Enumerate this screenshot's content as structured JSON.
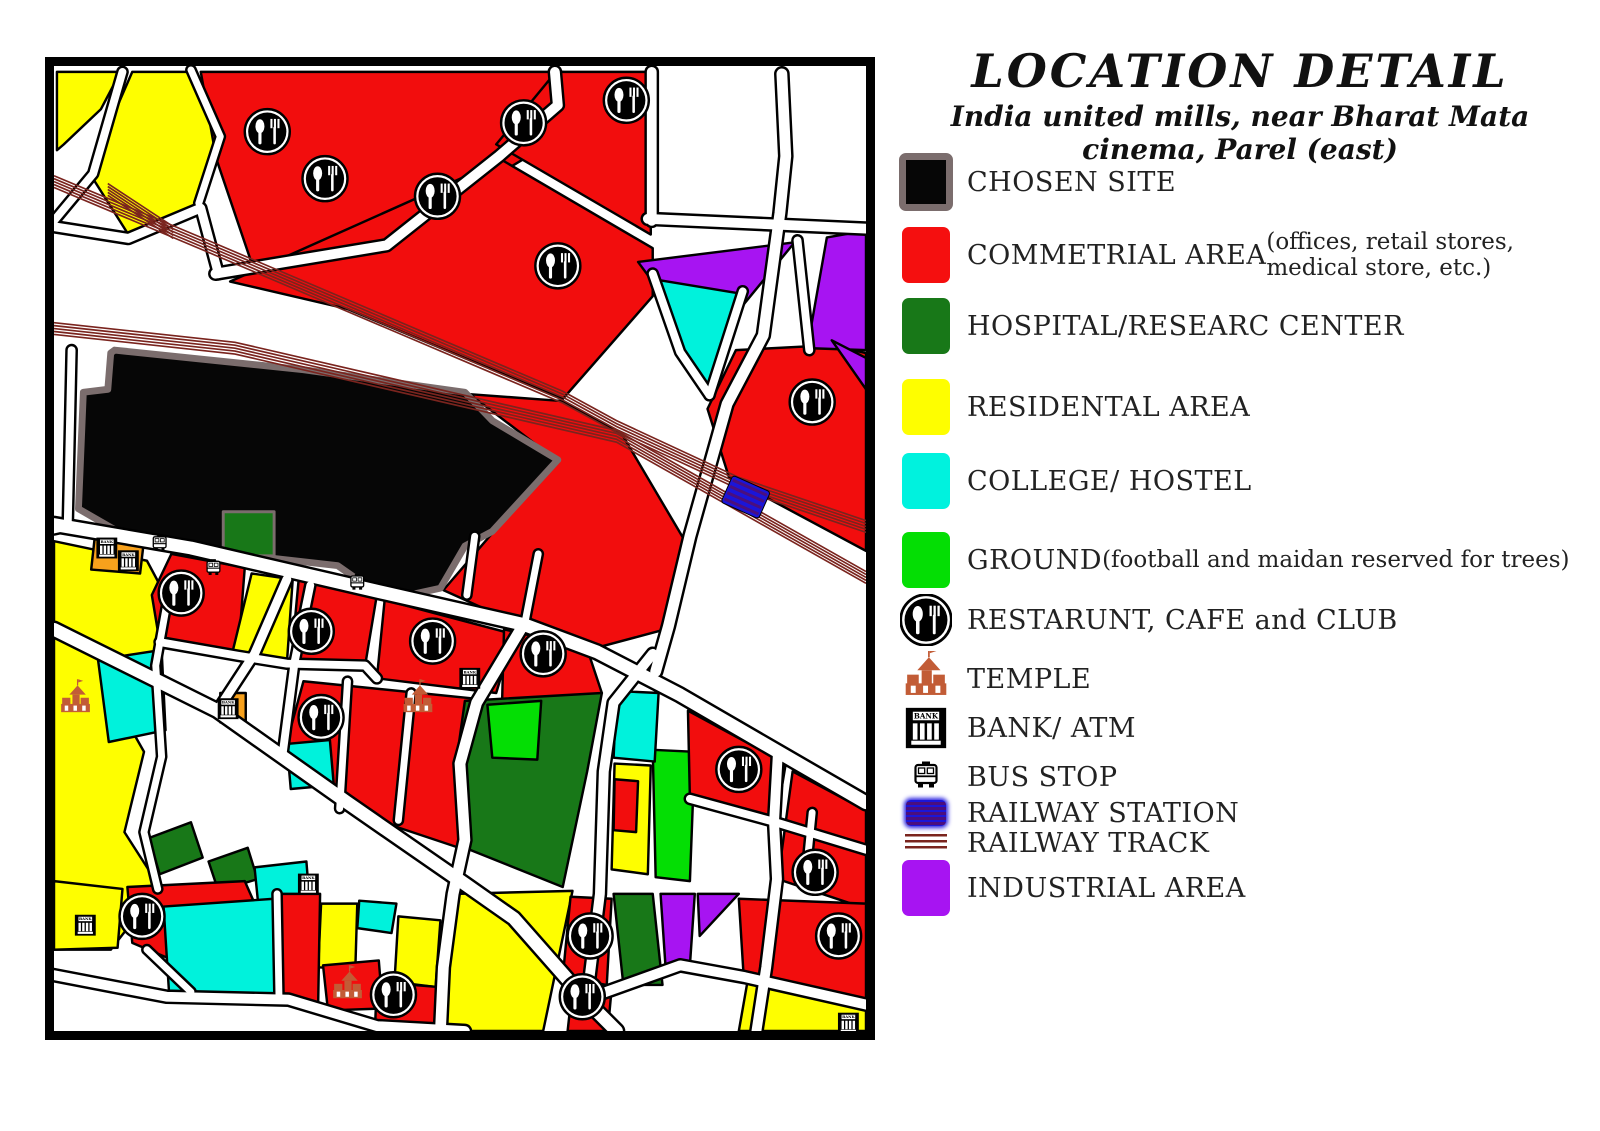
{
  "header": {
    "title": "LOCATION DETAIL",
    "subtitle": "India united mills, near Bharat Mata cinema, Parel (east)"
  },
  "legend": {
    "items": [
      {
        "name": "chosen-site",
        "label": "CHOSEN SITE",
        "swatch": "square-chosen",
        "color": "#060606",
        "top": 152,
        "h": 60
      },
      {
        "name": "commercial-area",
        "label": "COMMETRIAL AREA",
        "sub": " (offices, retail stores, medical store, etc.)",
        "swatch": "square",
        "color": "#f50f0f",
        "top": 226,
        "h": 58
      },
      {
        "name": "hospital-research",
        "label": " HOSPITAL/RESEARC CENTER",
        "swatch": "square",
        "color": "#187818",
        "top": 297,
        "h": 58
      },
      {
        "name": "residential-area",
        "label": "RESIDENTAL AREA",
        "swatch": "square",
        "color": "#fefe00",
        "top": 378,
        "h": 58
      },
      {
        "name": "college-hostel",
        "label": "COLLEGE/ HOSTEL",
        "swatch": "square",
        "color": "#00f2de",
        "top": 452,
        "h": 58
      },
      {
        "name": "ground",
        "label": "GROUND",
        "sub": " (football and maidan reserved for trees)",
        "swatch": "square",
        "color": "#04de04",
        "top": 531,
        "h": 58
      },
      {
        "name": "restaurant-cafe-club",
        "label": "RESTARUNT, CAFE and CLUB",
        "swatch": "restaurant",
        "top": 595,
        "h": 50
      },
      {
        "name": "temple",
        "label": "TEMPLE",
        "swatch": "temple",
        "top": 650,
        "h": 58
      },
      {
        "name": "bank-atm",
        "label": "BANK/ ATM",
        "swatch": "bank",
        "top": 702,
        "h": 52
      },
      {
        "name": "bus-stop",
        "label": "BUS STOP",
        "swatch": "bus",
        "top": 756,
        "h": 42
      },
      {
        "name": "railway-station",
        "label": "RAILWAY STATION",
        "swatch": "station",
        "top": 798,
        "h": 30
      },
      {
        "name": "railway-track",
        "label": "RAILWAY TRACK",
        "swatch": "track",
        "top": 832,
        "h": 22
      },
      {
        "name": "industrial-area",
        "label": "INDUSTRIAL AREA",
        "swatch": "square",
        "color": "#a714f2",
        "top": 858,
        "h": 60
      }
    ]
  },
  "map": {
    "colors": {
      "RED": "#f20d0d",
      "YEL": "#fefe00",
      "CYN": "#00f2dc",
      "DGR": "#187818",
      "BGR": "#04de04",
      "PUR": "#a714f2",
      "BLK": "#060606",
      "ORN": "#f7a11c",
      "track": "#7a241e",
      "site_border": "#7b6d6d",
      "road_casing": "#000000",
      "station_fill": "#1b15d8",
      "station_stripe": "#4a0f7e",
      "temple": "#c25c36"
    },
    "regions": [
      {
        "name": "yellow-nw-1",
        "fill": "YEL",
        "points": "3,6 68,6 48,44 10,80 3,86"
      },
      {
        "name": "yellow-nw-2",
        "fill": "YEL",
        "points": "80,6 138,6 168,70 146,142 76,172 38,112 60,52"
      },
      {
        "name": "red-north-west",
        "fill": "RED",
        "points": "150,6 520,6 480,95 338,180 205,210 166,95"
      },
      {
        "name": "red-north-mid",
        "fill": "RED",
        "points": "513,6 610,6 610,172 452,80"
      },
      {
        "name": "red-north-band",
        "fill": "RED",
        "points": "180,220 458,96 612,186 612,235 520,340 300,248"
      },
      {
        "name": "red-northeast",
        "fill": "RED",
        "points": "697,290 793,285 830,293 830,495 690,420 668,350"
      },
      {
        "name": "purple-ne-1",
        "fill": "PUR",
        "points": "597,200 757,180 665,292"
      },
      {
        "name": "purple-ne-2",
        "fill": "PUR",
        "points": "790,175 830,168 830,290 770,288"
      },
      {
        "name": "purple-ne-3",
        "fill": "PUR",
        "points": "795,280 830,298 830,330"
      },
      {
        "name": "cyan-north",
        "fill": "CYN",
        "points": "615,218 700,232 670,332 638,292"
      },
      {
        "name": "red-center-east",
        "fill": "RED",
        "points": "425,335 520,342 580,375 645,485 625,575 550,595 460,563 398,535 447,478 516,404"
      },
      {
        "name": "chosen-site",
        "fill": "BLK",
        "stroke": "site_border",
        "sw": 7,
        "points": "62,290 255,310 420,333 448,362 515,402 448,475 420,490 395,533 340,545 290,510 175,497 65,475 25,452 30,333 55,330 58,293"
      },
      {
        "name": "green-site-notch",
        "fill": "DGR",
        "stroke": "site_border",
        "sw": 3,
        "points": "173,455 225,455 225,500 173,500"
      },
      {
        "name": "yellow-west-column",
        "fill": "YEL",
        "points": "0,485 95,505 118,548 103,612 58,640 92,700 72,782 108,838 58,902 0,902"
      },
      {
        "name": "orange-bank-patch",
        "fill": "ORN",
        "points": "42,478 92,484 88,518 38,514"
      },
      {
        "name": "cyan-west",
        "fill": "CYN",
        "points": "45,606 110,596 114,678 56,690"
      },
      {
        "name": "red-block-a",
        "fill": "RED",
        "points": "120,498 195,512 188,602 108,588 100,540"
      },
      {
        "name": "yellow-block-a",
        "fill": "YEL",
        "points": "202,518 244,524 238,610 182,600"
      },
      {
        "name": "red-block-b",
        "fill": "RED",
        "points": "250,525 330,540 318,612 242,612"
      },
      {
        "name": "red-block-c",
        "fill": "RED",
        "points": "338,545 470,580 452,640 330,625"
      },
      {
        "name": "red-block-d",
        "fill": "RED",
        "points": "460,575 545,595 560,640 538,668 458,650"
      },
      {
        "name": "orange-patch",
        "fill": "ORN",
        "points": "170,640 196,640 196,670 170,670"
      },
      {
        "name": "red-block-center",
        "fill": "RED",
        "points": "255,628 452,648 540,675 520,760 420,800 300,760 238,690"
      },
      {
        "name": "cyan-block-a",
        "fill": "CYN",
        "points": "238,692 282,688 286,734 242,738"
      },
      {
        "name": "dgreen-diamond-1",
        "fill": "DGR",
        "points": "97,788 140,772 152,808 108,825"
      },
      {
        "name": "dgreen-diamond-2",
        "fill": "DGR",
        "points": "158,812 198,798 208,830 168,842"
      },
      {
        "name": "cyan-block-b",
        "fill": "CYN",
        "points": "205,818 258,812 262,862 210,868"
      },
      {
        "name": "hospital-main",
        "fill": "DGR",
        "points": "420,648 560,640 545,720 520,838 425,800 412,705"
      },
      {
        "name": "hospital-strip",
        "fill": "DGR",
        "points": "572,845 612,845 622,938 582,938"
      },
      {
        "name": "bgreen-a",
        "fill": "BGR",
        "points": "443,652 498,648 494,708 448,706"
      },
      {
        "name": "bgreen-b",
        "fill": "BGR",
        "points": "612,698 655,700 650,832 615,828"
      },
      {
        "name": "cyan-block-c",
        "fill": "CYN",
        "points": "575,638 618,640 614,710 572,706"
      },
      {
        "name": "yellow-block-b",
        "fill": "YEL",
        "points": "573,712 610,714 607,825 570,820"
      },
      {
        "name": "red-pocket",
        "fill": "RED",
        "points": "573,728 597,730 595,782 572,780"
      },
      {
        "name": "red-se-1",
        "fill": "RED",
        "points": "648,658 748,712 738,772 650,748"
      },
      {
        "name": "red-se-2",
        "fill": "RED",
        "points": "755,720 830,760 830,860 740,830"
      },
      {
        "name": "red-se-3",
        "fill": "RED",
        "points": "700,850 830,855 830,955 705,930"
      },
      {
        "name": "yellow-se",
        "fill": "YEL",
        "points": "710,928 830,960 830,985 700,985"
      },
      {
        "name": "yellow-south-mid",
        "fill": "YEL",
        "points": "410,845 530,842 500,985 395,985"
      },
      {
        "name": "red-south-a",
        "fill": "RED",
        "points": "528,848 570,850 565,938 520,930"
      },
      {
        "name": "red-south-e",
        "fill": "RED",
        "points": "530,940 570,942 566,985 525,985"
      },
      {
        "name": "purple-south-1",
        "fill": "PUR",
        "points": "620,845 655,845 650,918 625,918"
      },
      {
        "name": "purple-south-2",
        "fill": "PUR",
        "points": "658,845 700,845 660,888"
      },
      {
        "name": "yellow-sw-1",
        "fill": "YEL",
        "points": "0,832 70,840 65,900 0,902"
      },
      {
        "name": "red-sw-1",
        "fill": "RED",
        "points": "75,838 195,832 225,900 120,912 80,895"
      },
      {
        "name": "cyan-south",
        "fill": "CYN",
        "points": "112,858 225,850 230,950 118,952"
      },
      {
        "name": "cyan-south-2",
        "fill": "CYN",
        "points": "312,852 350,855 345,885 310,880"
      },
      {
        "name": "yellow-south-2",
        "fill": "YEL",
        "points": "273,855 310,855 308,922 270,920"
      },
      {
        "name": "yellow-south-3",
        "fill": "YEL",
        "points": "352,868 395,872 390,940 348,935"
      },
      {
        "name": "red-south-b",
        "fill": "RED",
        "points": "228,845 272,845 270,958 230,955"
      },
      {
        "name": "red-south-c",
        "fill": "RED",
        "points": "275,918 332,913 336,962 280,964"
      },
      {
        "name": "red-south-d",
        "fill": "RED",
        "points": "330,935 392,940 388,985 328,985"
      }
    ],
    "roads": [
      {
        "name": "main-road-south-of-site",
        "points": "0,468 140,492 330,536 480,570 555,598 640,642 740,700 830,752",
        "w": 13
      },
      {
        "name": "main-road-station",
        "points": "744,8 748,92 742,150 725,275 688,345 650,480 628,572 615,618",
        "w": 11
      },
      {
        "name": "diag-road-north",
        "points": "165,212 340,183 455,92 515,40 512,6",
        "w": 10
      },
      {
        "name": "white-area-road-v",
        "points": "611,6 611,158",
        "w": 10
      },
      {
        "name": "white-area-road-h",
        "points": "607,156 830,166",
        "w": 10
      },
      {
        "name": "purple-gap-road",
        "points": "760,178 772,290",
        "w": 8
      },
      {
        "name": "cyan-edge-road-1",
        "points": "612,212 640,292 670,336",
        "w": 8
      },
      {
        "name": "cyan-edge-road-2",
        "points": "670,336 704,230",
        "w": 8
      },
      {
        "name": "nw-road-1",
        "points": "70,6 40,110 0,158",
        "w": 8
      },
      {
        "name": "nw-road-2",
        "points": "140,4 170,72 148,140",
        "w": 7
      },
      {
        "name": "nw-road-3",
        "points": "0,164 76,176 150,145 168,212",
        "w": 9
      },
      {
        "name": "west-road",
        "points": "18,290 14,470 0,473",
        "w": 8
      },
      {
        "name": "west-col-road",
        "points": "116,545 104,612 110,705 92,782 106,840",
        "w": 7
      },
      {
        "name": "south-diagonal",
        "points": "0,575 167,658 300,752 420,835 470,870 545,955 575,985",
        "w": 13
      },
      {
        "name": "conn-1",
        "points": "238,524 205,600 167,658",
        "w": 9
      },
      {
        "name": "conn-2",
        "points": "262,530 246,608 234,700",
        "w": 8
      },
      {
        "name": "stub-1",
        "points": "495,498 482,565",
        "w": 7
      },
      {
        "name": "stub-2",
        "points": "430,480 422,540",
        "w": 7
      },
      {
        "name": "hospital-west-road",
        "points": "480,570 432,650 415,712 420,790 408,845 398,920 395,985",
        "w": 11
      },
      {
        "name": "hospital-east-road",
        "points": "612,600 572,650 562,720 558,845 545,950",
        "w": 10
      },
      {
        "name": "se-vertical-road",
        "points": "740,700 736,772 739,830 728,920 718,985",
        "w": 10
      },
      {
        "name": "sw-bottom-road",
        "points": "0,928 115,950 240,953 330,980 420,985",
        "w": 10
      },
      {
        "name": "south-bottom-road",
        "points": "545,952 640,918 706,930 830,958",
        "w": 10
      },
      {
        "name": "se-cross-road",
        "points": "650,748 738,772 830,800",
        "w": 8
      },
      {
        "name": "se-stub",
        "points": "775,762 768,832",
        "w": 7
      },
      {
        "name": "center-split-1",
        "points": "300,628 292,758",
        "w": 7
      },
      {
        "name": "center-split-2",
        "points": "365,640 352,770",
        "w": 7
      },
      {
        "name": "mid-ew-street",
        "points": "108,588 188,602 238,610 318,612 330,625",
        "w": 8
      },
      {
        "name": "sw-stub-1",
        "points": "95,902 140,945",
        "w": 7
      },
      {
        "name": "sw-stub-2",
        "points": "228,845 230,952",
        "w": 7
      }
    ],
    "tracks": [
      {
        "name": "track-a",
        "points": "0,118 155,183 520,338 575,368 700,426 830,470"
      },
      {
        "name": "track-b",
        "points": "0,268 185,288 575,378 830,522"
      },
      {
        "name": "track-spur",
        "points": "55,126 122,170"
      }
    ],
    "station": {
      "x": 707,
      "y": 440,
      "w": 42,
      "h": 30,
      "angle": 24
    },
    "icons": {
      "restaurant": [
        [
          218,
          67
        ],
        [
          277,
          115
        ],
        [
          392,
          133
        ],
        [
          480,
          58
        ],
        [
          585,
          35
        ],
        [
          515,
          204
        ],
        [
          775,
          343
        ],
        [
          130,
          538
        ],
        [
          263,
          577
        ],
        [
          387,
          587
        ],
        [
          500,
          600
        ],
        [
          273,
          665
        ],
        [
          700,
          718
        ],
        [
          778,
          823
        ],
        [
          802,
          888
        ],
        [
          90,
          868
        ],
        [
          347,
          948
        ],
        [
          548,
          888
        ],
        [
          540,
          950
        ]
      ],
      "temple": [
        [
          22,
          648
        ],
        [
          372,
          648
        ],
        [
          300,
          940
        ]
      ],
      "bank": [
        [
          54,
          492
        ],
        [
          76,
          505
        ],
        [
          178,
          656
        ],
        [
          425,
          625
        ],
        [
          260,
          835
        ],
        [
          32,
          877
        ],
        [
          812,
          977
        ]
      ],
      "bus": [
        [
          108,
          488
        ],
        [
          163,
          513
        ],
        [
          310,
          528
        ]
      ]
    }
  }
}
